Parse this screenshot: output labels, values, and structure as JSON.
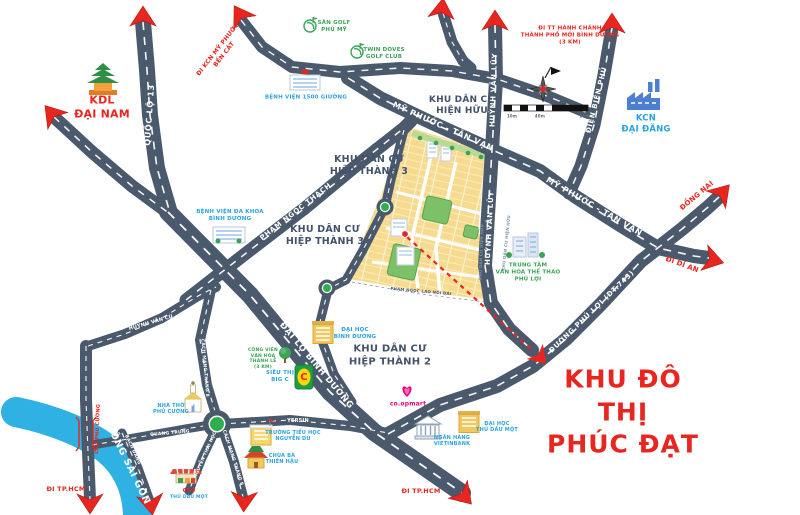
{
  "title": {
    "text": "KHU ĐÔ THỊ\nPHÚC ĐẠT"
  },
  "areas": {
    "kdl_dai_nam": "KDL\nĐẠI NAM",
    "hien_huu": "KHU DÂN CƯ\nHIỆN HỮU",
    "hiep_thanh3_a": "KHU DÂN CƯ\nHIỆP THÀNH 3",
    "hiep_thanh3_b": "KHU DÂN CƯ\nHIỆP THÀNH 3",
    "hiep_thanh2": "KHU DÂN CƯ\nHIỆP THÀNH 2",
    "kcn_dai_dang": "KCN\nĐẠI ĐĂNG"
  },
  "roads": {
    "quoc_lo_13": "QUỐC LỘ 13",
    "pham_ngoc_thach": "PHẠM NGỌC THẠCH",
    "my_phuoc_tan_van_1": "MỸ PHƯỚC - TÂN VẠN",
    "my_phuoc_tan_van_2": "MỸ PHƯỚC - TÂN VẠN",
    "huynh_van_luy_1": "HUỲNH VĂN LŨY",
    "huynh_van_luy_2": "HUỲNH VĂN LŨY",
    "dien_bien_phu": "ĐIỆN BIÊN PHỦ",
    "dai_lo_binh_duong": "ĐẠI LỘ BÌNH DƯƠNG",
    "duong_phu_loi": "ĐƯỜNG PHÚ LỢI (ĐT.743)",
    "huynh_van_cu": "HUỲNH VĂN CÙ",
    "cach_mang_thang8_n": "CÁCH MẠNG THÁNG 8",
    "cach_mang_thang8_s": "CÁCH MẠNG THÁNG 8",
    "nguyen_thai_hoc": "NGUYỄN THÁI HỌC",
    "quang_trung": "QUANG TRUNG",
    "yersin": "YERSIN",
    "bach_dang": "BẠCH ĐẰNG",
    "cau_phu_cuong": "CẦU PHÚ CƯỜNG",
    "pham_ngoc_lao": "PHẠM NGỌC LÃO NỐI DÀI",
    "song_sai_gon": "SÔNG SÀI GÒN",
    "strip_1": "KHU DÂN CƯ HIỆN HỮU",
    "strip_2": "KHU DÂN CƯ HIỆN HỮU"
  },
  "directions": {
    "di_kcn": "ĐI KCN MỸ PHƯỚC\nBẾN CÁT",
    "di_tt": "ĐI TT HÀNH CHÁNH\nTHÀNH PHỐ MỚI BÌNH DƯƠNG\n(3 KM)",
    "dong_nai": "ĐỒNG NAI",
    "di_di_an": "ĐI DĨ AN",
    "di_tphcm_1": "ĐI TP.HCM",
    "di_tphcm_2": "ĐI TP.HCM"
  },
  "landmarks": {
    "san_golf": "SÂN GOLF\nPHÚ MỸ",
    "twin_doves": "TWIN DOVES\nGOLF CLUB",
    "bv_1500": "BỆNH VIỆN 1500 GIƯỜNG",
    "bv_da_khoa": "BỆNH VIỆN ĐA KHOA\nBÌNH DƯƠNG",
    "tt_van_hoa": "TRUNG TÂM\nVĂN HÓA THỂ THAO\nPHÚ LỢI",
    "dh_binh_duong": "ĐẠI HỌC\nBÌNH DƯƠNG",
    "cong_vien": "CÔNG VIÊN\nVĂN HÓA\nTHANH LỄ\n(3 KM)",
    "sieu_thi_bigc": "SIÊU THỊ\nBIG C",
    "bigc_letter": "C",
    "coopmart": "co.opmart",
    "truong_nguyen_du": "TRƯỜNG TIỂU HỌC\nNGUYỄN DU",
    "chua_ba": "CHÙA BÀ\nTHIÊN HẬU",
    "nha_tho": "NHÀ THỜ\nPHÚ CƯỜNG",
    "cho_1": "CHỢ",
    "cho_2": "THỦ DẦU MỘT",
    "ngan_hang": "NGÂN HÀNG\nVIETINBANK",
    "dh_thu_dau_mot": "ĐẠI HỌC\nTHỦ DẦU MỘT"
  },
  "scale": {
    "t1": "10m",
    "t2": "40m",
    "t3": "80m"
  },
  "colors": {
    "accent_red": "#e8251f",
    "navy": "#44536b",
    "landmark_blue": "#29a3dd",
    "green": "#3aa356",
    "road": "#4a5a6c",
    "river": "#2fb1e3",
    "lots_yellow": "#f6da90",
    "coop_pink": "#e6007e"
  }
}
